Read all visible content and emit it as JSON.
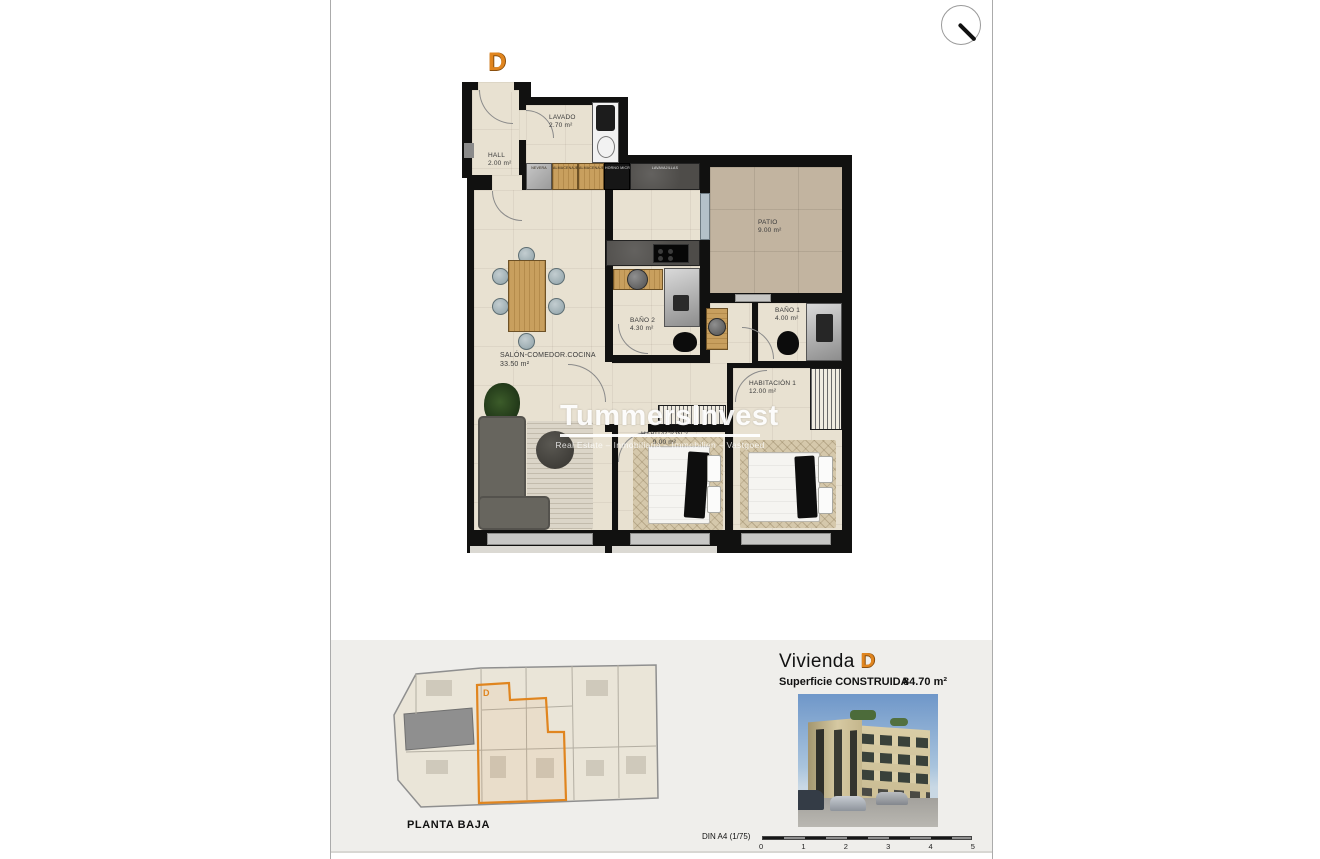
{
  "window": {
    "zoom_icon": "magnifier-cursor"
  },
  "plan": {
    "unit_letter": "D",
    "rooms": [
      {
        "label": "LAVADO",
        "area": "2.70 m²"
      },
      {
        "label": "HALL",
        "area": "2.00 m²"
      },
      {
        "label": "PATIO",
        "area": "9.00 m²"
      },
      {
        "label": "BAÑO 2",
        "area": "4.30 m²"
      },
      {
        "label": "BAÑO 1",
        "area": "4.00 m²"
      },
      {
        "label": "SALÓN-COMEDOR.COCINA",
        "area": "33.50 m²"
      },
      {
        "label": "HABITACIÓN 1",
        "area": "12.00 m²"
      },
      {
        "label": "HABITACIÓN 2",
        "area": "9.00 m²"
      }
    ],
    "kitchen_units": [
      "NEVERA",
      "ALMACENAJE",
      "ALMACENAJE",
      "HORNO MICRO",
      "LAVAVAJILLAS"
    ],
    "watermark": {
      "title": "TummersInvest",
      "subtitle": "Real Estate – Inmobiliaria – Immobilien – Vastgoed"
    }
  },
  "footer": {
    "site_plan": {
      "caption": "PLANTA BAJA",
      "unit_letter": "D"
    },
    "unit": {
      "title": "Vivienda",
      "letter": "D"
    },
    "surface": {
      "label": "Superficie CONSTRUIDA",
      "value": "84.70 m²"
    },
    "scale": {
      "label": "DIN A4 (1/75)",
      "ticks": [
        "0",
        "1",
        "2",
        "3",
        "4",
        "5"
      ]
    }
  },
  "colors": {
    "accent_orange": "#e0851f",
    "wall_black": "#111110",
    "floor_cream": "#e8e1d1",
    "patio_tan": "#c2b4a0",
    "footer_panel": "#efeeeb"
  }
}
